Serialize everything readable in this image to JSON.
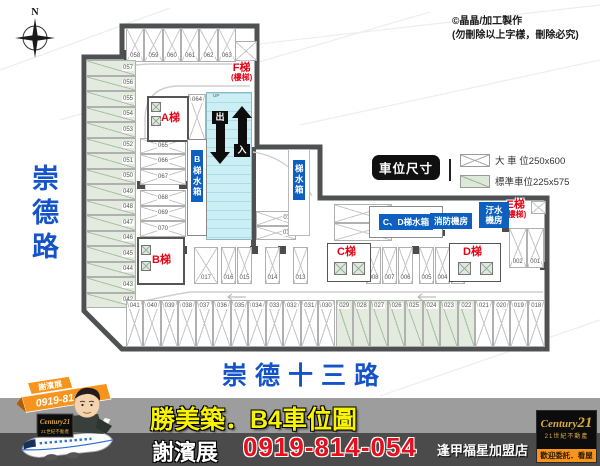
{
  "credits": {
    "line1": "©晶晶/加工製作",
    "line2": "(勿刪除以上字樣，刪除必究)"
  },
  "compass": {
    "north": "N"
  },
  "roads": {
    "left": "崇德路",
    "bottom": "崇德十三路"
  },
  "legend": {
    "title": "車位尺寸",
    "items": [
      {
        "type": "large",
        "label": "大 車 位250x600"
      },
      {
        "type": "standard",
        "label": "標準車位225x575"
      }
    ]
  },
  "plan": {
    "labels": {
      "stair_a": "A梯",
      "stair_b": "B梯",
      "stair_c": "C梯",
      "stair_d": "D梯",
      "stair_e": "E梯",
      "stair_e_sub": "(樓梯)",
      "stair_f": "F梯",
      "stair_f_sub": "(樓梯)",
      "tank_b": "B梯水箱",
      "tank_mid": "梯水箱",
      "tank_cd": "C、D梯水箱",
      "fire_room": "消防機房",
      "sewage_room": "汙水機房",
      "exit": "出",
      "enter": "入",
      "up": "UP"
    },
    "spaces": {
      "top_row": [
        "058",
        "059",
        "060",
        "061",
        "062",
        "063"
      ],
      "left_col": [
        "057",
        "056",
        "055",
        "054",
        "053",
        "052",
        "051",
        "050",
        "049",
        "048",
        "047",
        "046",
        "045",
        "044",
        "043",
        "042"
      ],
      "upper_mid_a": [
        "065",
        "066",
        "067"
      ],
      "upper_mid_b": [
        "068",
        "069",
        "070"
      ],
      "space_64": [
        "064"
      ],
      "mid_pair": [
        "011",
        "012"
      ],
      "mid_row": [
        "017",
        "016",
        "015",
        "014",
        "013"
      ],
      "right_pair": [
        "010",
        "009"
      ],
      "c_row": [
        "008",
        "007",
        "006",
        "005",
        "004",
        "003"
      ],
      "e_pair": [
        "002",
        "001"
      ],
      "bottom_row": [
        "041",
        "040",
        "039",
        "038",
        "037",
        "036",
        "035",
        "034",
        "033",
        "032",
        "031",
        "030",
        "029",
        "028",
        "027",
        "026",
        "025",
        "024",
        "023",
        "022",
        "021",
        "020",
        "019",
        "018"
      ],
      "bottom_row_standard": [
        "029",
        "028",
        "027",
        "026",
        "025",
        "024",
        "023",
        "022"
      ]
    }
  },
  "banner": {
    "title": "勝美築．B4車位圖",
    "agent": "謝濱展",
    "phone": "0919-814-054",
    "store": "逢甲福星加盟店",
    "c21": {
      "brand": "Century",
      "brand_num": "21",
      "sub": "21世紀不動產",
      "tag": "歡迎委託．看屋"
    },
    "mascot": {
      "name": "謝濱展",
      "phone": "0919-814054",
      "sign_brand": "Century21",
      "sign_sub": "21世紀不動產"
    }
  }
}
